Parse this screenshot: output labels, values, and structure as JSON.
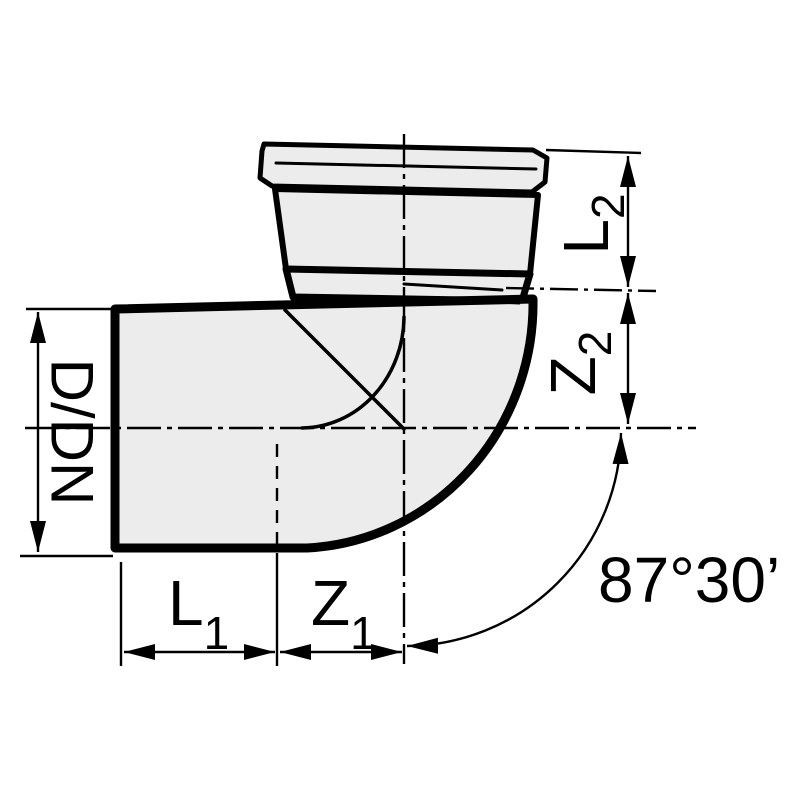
{
  "drawing": {
    "colors": {
      "line": "#000000",
      "fill": "#ececec",
      "background": "#ffffff"
    },
    "labels": {
      "diameter": "D/DN",
      "l1": {
        "base": "L",
        "sub": "1"
      },
      "z1": {
        "base": "Z",
        "sub": "1"
      },
      "l2": {
        "base": "L",
        "sub": "2"
      },
      "z2": {
        "base": "Z",
        "sub": "2"
      },
      "angle": "87°30’"
    }
  }
}
